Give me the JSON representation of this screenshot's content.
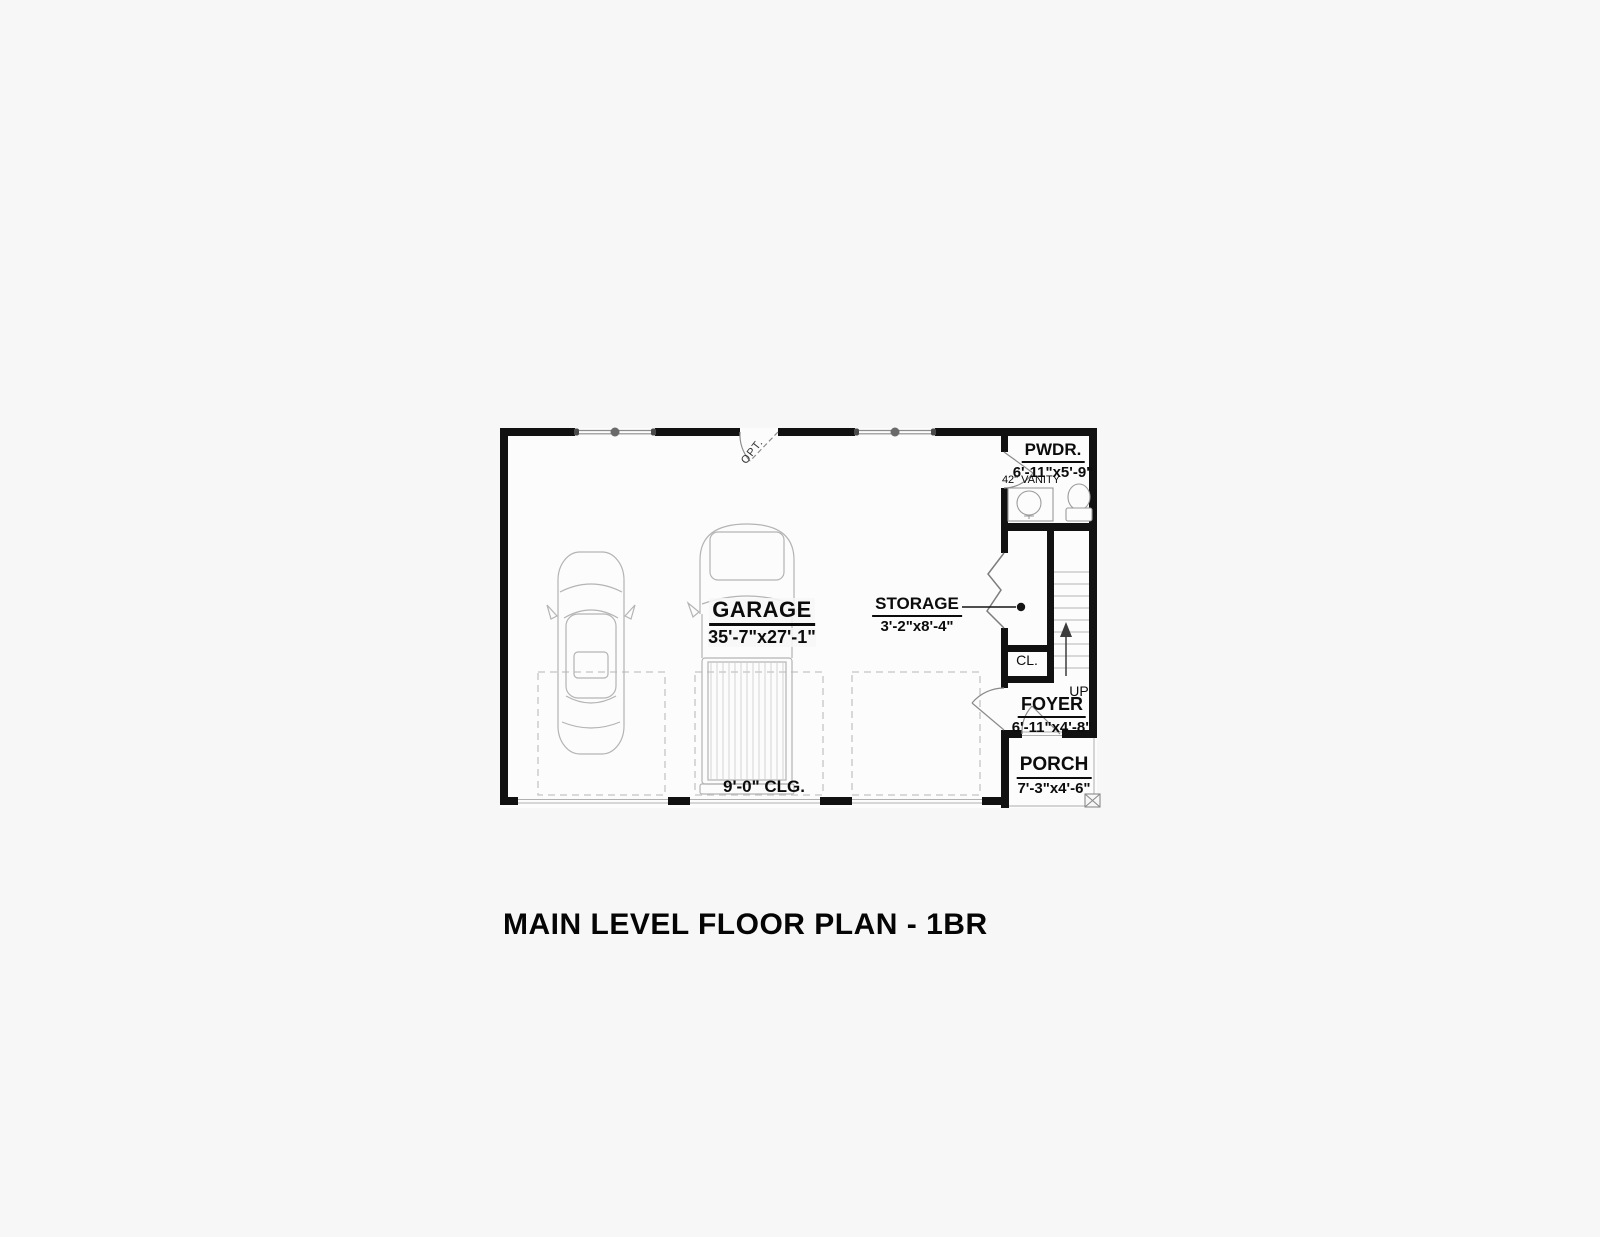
{
  "title": "MAIN LEVEL FLOOR PLAN - 1BR",
  "rooms": {
    "garage": {
      "label": "GARAGE",
      "dims": "35'-7\"x27'-1\"",
      "ceiling_note": "9'-0\" CLG."
    },
    "powder_room": {
      "label": "PWDR.",
      "dims": "6'-11\"x5'-9\"",
      "vanity_note": "42\" VANITY"
    },
    "storage": {
      "label": "STORAGE",
      "dims": "3'-2\"x8'-4\""
    },
    "closet": {
      "label": "CL."
    },
    "foyer": {
      "label": "FOYER",
      "dims": "6'-11\"x4'-8\""
    },
    "porch": {
      "label": "PORCH",
      "dims": "7'-3\"x4'-6\""
    },
    "stairs": {
      "label": "UP"
    }
  },
  "notes": {
    "optional_door": "OPT."
  },
  "symbols": [
    "sedan-car",
    "pickup-truck",
    "toilet",
    "vanity-sink",
    "bifold-door",
    "window",
    "door-swing",
    "stairs-up",
    "porch-post",
    "parking-pad"
  ],
  "colors": {
    "wall": "#111111",
    "thin_line": "#8d8d8d",
    "faint_line": "#c4c4c4",
    "background": "#f7f7f7",
    "floor": "#fcfcfc",
    "text": "#0c0c0c"
  }
}
